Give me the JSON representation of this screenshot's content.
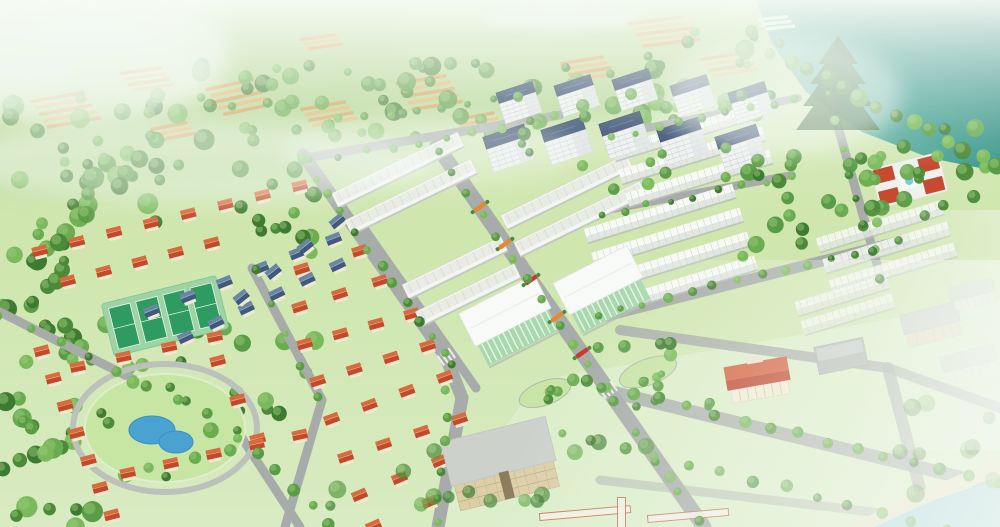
{
  "meta": {
    "description": "Aerial 3D rendering of a master-planned residential community with red-roof villas, white townhouse rows, apartment towers, a central park pond, tennis courts, a lake and distant hillside villages",
    "width": 1000,
    "height": 527
  },
  "palette": {
    "base_top": "#dcecc6",
    "base_mid": "#cfe6ad",
    "base_bottom": "#d8ebc2",
    "lawn_pale": "#ddeecb",
    "hill1": "#b7d795",
    "hill2": "#a8cf85",
    "hill3": "#c7e0a8",
    "stream": "#cfe4da",
    "lake_deep": "#24807a",
    "lake_mid": "#43a093",
    "lake_pale": "#8fcbba",
    "road": "#a7acaa",
    "road_faded": "#c3c7c4",
    "white_body": "#f4f6f1",
    "roof_inner": "#e9ece5",
    "roof_stripe": "#d2d8d1",
    "eave": "#bfc4be",
    "gable_hi": "#f7f9f5",
    "gable_lo": "#e3e7e1",
    "navy": "#2c4468",
    "navy_dark": "#1f3352",
    "red_roof": "#c24a28",
    "red_roof_hi": "#d96a3c",
    "slate_roof": "#3f5a7c",
    "slate_roof_hi": "#6a85a5",
    "wall_cream": "#f1e9d2",
    "glass_green": "#a9d8ad",
    "glass_stripe": "#e8f5e9",
    "court_green": "#2e9c60",
    "court_pad": "#9ed4a4",
    "pond_blue": "#4aa2d2",
    "pond_edge": "#3a8fc2",
    "park_lawn": "#c7e5a3",
    "sand": "#e9e5c8",
    "sea": "#a6d8e0",
    "orange_strip": "#dd9850",
    "orange_strip2": "#e8b068",
    "flower_orange": "#e28a33",
    "flower_red": "#cc3824",
    "tan_wall": "#dccfa8",
    "tan_roof": "#ccd1cc",
    "pine": "#2c5a2d",
    "haze": "#f6fbf6",
    "tree_greens": [
      "#3e7a31",
      "#4c8a3a",
      "#5a9c45",
      "#6aac50",
      "#7aba5c"
    ],
    "tree_hi": "#9ccf7a"
  },
  "scene": {
    "hills": [
      [
        150,
        60,
        260,
        90,
        "hill3",
        0.8
      ],
      [
        480,
        45,
        300,
        80,
        "hill2",
        0.7
      ],
      [
        700,
        30,
        200,
        60,
        "hill1",
        0.6
      ],
      [
        120,
        145,
        300,
        55,
        "hill2",
        0.5
      ]
    ],
    "streams": [
      [
        90,
        35,
        70,
        18
      ],
      [
        35,
        70,
        40,
        12
      ],
      [
        560,
        18,
        80,
        12
      ]
    ],
    "lake": {
      "points": [
        [
          756,
          0
        ],
        [
          1000,
          0
        ],
        [
          1000,
          172
        ],
        [
          930,
          158
        ],
        [
          862,
          132
        ],
        [
          806,
          92
        ],
        [
          772,
          44
        ]
      ]
    },
    "distant_clusters": [
      [
        30,
        100,
        -10,
        5,
        55,
        7,
        "o"
      ],
      [
        120,
        72,
        -8,
        4,
        42,
        6,
        "o"
      ],
      [
        205,
        88,
        -12,
        5,
        50,
        7,
        "o"
      ],
      [
        300,
        108,
        -10,
        4,
        46,
        6,
        "o"
      ],
      [
        395,
        82,
        -9,
        5,
        52,
        7,
        "o"
      ],
      [
        300,
        38,
        -8,
        3,
        36,
        5,
        "o"
      ],
      [
        455,
        118,
        -10,
        3,
        40,
        6,
        "o"
      ],
      [
        560,
        62,
        -9,
        4,
        44,
        6,
        "o"
      ],
      [
        628,
        22,
        -7,
        5,
        58,
        6,
        "o"
      ],
      [
        700,
        58,
        -9,
        4,
        46,
        6,
        "o"
      ],
      [
        150,
        128,
        -11,
        3,
        38,
        6,
        "o"
      ],
      [
        758,
        18,
        -6,
        3,
        30,
        5,
        "w"
      ]
    ],
    "forests": [
      [
        0,
        95,
        210,
        130,
        40,
        5,
        11,
        0.92,
        "back",
        11
      ],
      [
        200,
        62,
        370,
        82,
        52,
        4,
        10,
        0.9,
        "back",
        22
      ],
      [
        565,
        30,
        215,
        92,
        38,
        4,
        10,
        0.95,
        "back",
        33
      ],
      [
        0,
        212,
        75,
        150,
        24,
        5,
        10,
        1,
        "back",
        44
      ],
      [
        52,
        322,
        285,
        105,
        30,
        5,
        10,
        1,
        "back",
        55
      ],
      [
        0,
        398,
        130,
        129,
        24,
        6,
        11,
        1,
        "back",
        66
      ],
      [
        236,
        150,
        80,
        110,
        14,
        5,
        9,
        1,
        "back",
        144
      ],
      [
        742,
        152,
        122,
        112,
        16,
        5,
        9,
        1,
        "front",
        77
      ],
      [
        848,
        128,
        150,
        100,
        22,
        5,
        9,
        0.95,
        "front",
        88
      ],
      [
        330,
        428,
        350,
        95,
        16,
        5,
        9,
        0.7,
        "front",
        99
      ],
      [
        560,
        338,
        150,
        85,
        12,
        4,
        7,
        0.95,
        "front",
        111
      ],
      [
        898,
        398,
        100,
        125,
        9,
        6,
        10,
        0.55,
        "front",
        122
      ],
      [
        492,
        92,
        272,
        100,
        18,
        4,
        7,
        0.95,
        "front",
        133
      ]
    ],
    "roads": [
      [
        303,
        155,
        446,
        357,
        13
      ],
      [
        446,
        357,
        462,
        398,
        13
      ],
      [
        462,
        398,
        438,
        527,
        13
      ],
      [
        437,
        146,
        608,
        390,
        15
      ],
      [
        608,
        390,
        704,
        527,
        15
      ],
      [
        305,
        158,
        560,
        115,
        9
      ],
      [
        612,
        135,
        798,
        98,
        8
      ],
      [
        597,
        212,
        792,
        175,
        8
      ],
      [
        828,
        92,
        882,
        282,
        9
      ],
      [
        598,
        318,
        905,
        240,
        11
      ],
      [
        604,
        390,
        1000,
        487,
        13,
        0.85
      ],
      [
        620,
        330,
        888,
        368,
        10,
        0.85
      ],
      [
        888,
        368,
        1000,
        408,
        10,
        0.8
      ],
      [
        888,
        368,
        930,
        527,
        12,
        0.8
      ],
      [
        0,
        312,
        238,
        432,
        9
      ],
      [
        238,
        432,
        300,
        527,
        9
      ],
      [
        252,
        268,
        322,
        400,
        9
      ],
      [
        322,
        400,
        285,
        527,
        9
      ],
      [
        365,
        230,
        476,
        388,
        9
      ],
      [
        600,
        480,
        1000,
        527,
        9,
        0.5
      ]
    ],
    "crosswalks": [
      [
        446,
        357,
        55
      ],
      [
        608,
        390,
        55
      ]
    ],
    "flower_medians": [
      [
        480,
        207,
        "o"
      ],
      [
        505,
        244,
        "o"
      ],
      [
        531,
        280,
        "r"
      ],
      [
        557,
        317,
        "o"
      ],
      [
        582,
        353,
        "r"
      ]
    ],
    "islands": [
      [
        545,
        393,
        27,
        12,
        -20
      ],
      [
        648,
        372,
        30,
        13,
        -20
      ]
    ],
    "tree_lines": [
      [
        303,
        160,
        446,
        355,
        12,
        4.5
      ],
      [
        450,
        362,
        436,
        524,
        7,
        4.5
      ],
      [
        437,
        150,
        605,
        388,
        12,
        4
      ],
      [
        614,
        402,
        700,
        522,
        5,
        4.5
      ],
      [
        598,
        316,
        900,
        242,
        14,
        4
      ],
      [
        828,
        96,
        880,
        278,
        8,
        4
      ],
      [
        604,
        386,
        996,
        482,
        15,
        5
      ],
      [
        560,
        432,
        945,
        527,
        13,
        5,
        0.8
      ],
      [
        0,
        314,
        236,
        430,
        9,
        4.5
      ],
      [
        254,
        272,
        318,
        396,
        5,
        4
      ],
      [
        792,
        62,
        998,
        166,
        13,
        7.5
      ],
      [
        340,
        120,
        520,
        98,
        8,
        4
      ],
      [
        240,
        436,
        330,
        524,
        6,
        5
      ],
      [
        612,
        136,
        796,
        100,
        9,
        3.5
      ],
      [
        600,
        214,
        790,
        178,
        9,
        3.5
      ],
      [
        310,
        162,
        556,
        118,
        10,
        4
      ]
    ],
    "villa_rows": [
      [
        40,
        252,
        300,
        187,
        8,
        "red"
      ],
      [
        68,
        282,
        212,
        244,
        5,
        "red"
      ],
      [
        302,
        270,
        360,
        252,
        2,
        "red"
      ],
      [
        300,
        308,
        380,
        282,
        3,
        "red"
      ],
      [
        305,
        345,
        412,
        315,
        4,
        "red"
      ],
      [
        318,
        382,
        428,
        347,
        4,
        "red"
      ],
      [
        332,
        420,
        445,
        378,
        4,
        "red"
      ],
      [
        346,
        458,
        460,
        420,
        4,
        "red"
      ],
      [
        360,
        496,
        440,
        462,
        3,
        "red"
      ],
      [
        374,
        527,
        430,
        503,
        2,
        "red"
      ],
      [
        78,
        368,
        215,
        338,
        4,
        "red"
      ],
      [
        218,
        362,
        258,
        440,
        3,
        "red",
        -15
      ],
      [
        128,
        474,
        300,
        436,
        5,
        "red"
      ],
      [
        42,
        352,
        112,
        516,
        7,
        "red",
        -15
      ],
      [
        152,
        312,
        334,
        240,
        6,
        "blue"
      ],
      [
        186,
        338,
        338,
        266,
        6,
        "blue"
      ],
      [
        242,
        298,
        338,
        222,
        4,
        "blue"
      ]
    ],
    "row_blocks": [
      [
        398,
        170,
        140,
        -26,
        2,
        30,
        "flat",
        1
      ],
      [
        567,
        192,
        140,
        -26,
        2,
        30,
        "flat",
        1
      ],
      [
        455,
        268,
        110,
        -26,
        2,
        30,
        "flat",
        1
      ],
      [
        685,
        132,
        150,
        -17,
        3,
        24,
        "gable",
        1
      ],
      [
        660,
        213,
        155,
        -17,
        4,
        25,
        "gable",
        1
      ],
      [
        880,
        226,
        130,
        -17,
        3,
        22,
        "gable",
        0.85
      ],
      [
        842,
        295,
        95,
        -17,
        2,
        20,
        "gable",
        0.75
      ]
    ],
    "apartment_towers": [
      [
        520,
        106,
        38
      ],
      [
        578,
        99,
        38
      ],
      [
        636,
        93,
        38
      ],
      [
        694,
        99,
        38
      ],
      [
        752,
        106,
        38
      ],
      [
        510,
        152,
        43
      ],
      [
        568,
        145,
        43
      ],
      [
        626,
        139,
        43
      ],
      [
        684,
        145,
        43
      ],
      [
        742,
        152,
        43
      ]
    ],
    "commercial": [
      [
        512,
        325,
        85,
        66
      ],
      [
        605,
        294,
        83,
        64
      ]
    ],
    "tennis": {
      "cx": 165,
      "cy": 316,
      "rot": -14,
      "pad_w": 118,
      "pad_h": 54,
      "courts": 4
    },
    "park": {
      "cx": 165,
      "cy": 428,
      "rx": 80,
      "ry": 54,
      "ponds": [
        [
          152,
          430,
          23,
          14
        ],
        [
          176,
          442,
          17,
          11
        ]
      ]
    },
    "misc_buildings": [
      {
        "type": "school",
        "x": 874,
        "y": 160,
        "w": 70,
        "h": 40,
        "rot": -14
      },
      {
        "type": "colonial",
        "x": 726,
        "y": 356,
        "w": 64,
        "h": 46,
        "rot": -10
      },
      {
        "type": "grayflat",
        "x": 816,
        "y": 342,
        "w": 50,
        "h": 28,
        "rot": -12
      },
      {
        "type": "beige",
        "x": 903,
        "y": 308,
        "w": 58,
        "h": 36,
        "rot": -14
      },
      {
        "type": "slab",
        "x": 950,
        "y": 282,
        "w": 46,
        "h": 26,
        "rot": -14,
        "op": 0.7
      },
      {
        "type": "slab",
        "x": 942,
        "y": 350,
        "w": 56,
        "h": 30,
        "rot": -14,
        "op": 0.6
      },
      {
        "type": "tan",
        "x": 448,
        "y": 424,
        "w": 108,
        "h": 84,
        "rot": -14
      }
    ],
    "landmark_pine": {
      "cx": 838,
      "tipY": 36,
      "baseY": 130,
      "opacity": 0.82
    },
    "beach": {
      "sand": [
        [
          846,
          527
        ],
        [
          918,
          492
        ],
        [
          1000,
          458
        ],
        [
          1000,
          476
        ],
        [
          930,
          502
        ],
        [
          874,
          527
        ]
      ],
      "water": [
        [
          874,
          527
        ],
        [
          934,
          500
        ],
        [
          1000,
          478
        ],
        [
          1000,
          527
        ]
      ],
      "walkways": [
        [
          540,
          514,
          90,
          6,
          -5
        ],
        [
          618,
          498,
          7,
          32,
          0
        ],
        [
          648,
          516,
          80,
          6,
          -5
        ]
      ]
    },
    "mists": [
      [
        190,
        162,
        240,
        42,
        0.5
      ],
      [
        70,
        55,
        160,
        70,
        0.65
      ],
      [
        430,
        150,
        150,
        34,
        0.35
      ],
      [
        782,
        95,
        120,
        60,
        0.5
      ]
    ]
  }
}
